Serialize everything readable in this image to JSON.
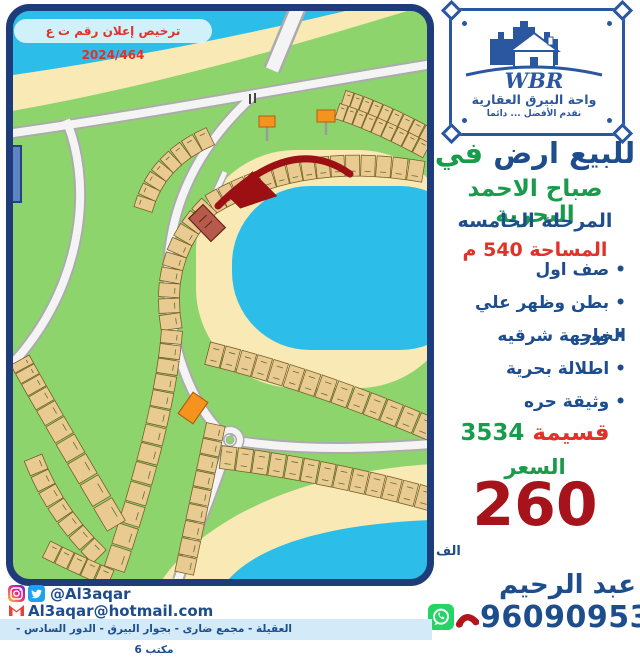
{
  "license": {
    "text": "ترخيص إعلان رقم ت ع 2024/464"
  },
  "logo": {
    "wbr": "WBR",
    "company": "واحة البيرق العقارية",
    "tagline": "نقدم الأفضل ... دائما"
  },
  "listing": {
    "title_main": "للبيع ارض",
    "title_in": "في",
    "location": "صباح الاحمد البحرية",
    "phase": "المرحلة الخامسه",
    "area": "المساحة 540 م",
    "features": [
      "صف اول",
      "بطن وظهر علي الخور",
      "واجهة شرقيه",
      "اطلالة بحرية",
      "وثيقة حره"
    ],
    "plot_label": "قسيمة",
    "plot_number": "3534",
    "price_label": "السعر",
    "price": "260",
    "price_unit": "الف"
  },
  "contact": {
    "name": "عبد الرحيم",
    "phone": "96090953",
    "social_handle": "@Al3aqar",
    "email": "Al3aqar@hotmail.com",
    "address": "العقيلة - مجمع ضارى - بجوار البيرق - الدور السادس - مكتب 6"
  },
  "colors": {
    "blue": "#1d4d8c",
    "logo_blue": "#2a579f",
    "green": "#189b4b",
    "red": "#e23128",
    "dark_red": "#a6131b",
    "strip": "#d3eaf8",
    "map_frame": "#1f3c7a",
    "water": "#2dbde9",
    "sand": "#f9e9b4",
    "map_green": "#8ed46d",
    "whatsapp_green": "#25d366",
    "twitter_blue": "#1da1f2",
    "gmail_red": "#e8433a"
  }
}
